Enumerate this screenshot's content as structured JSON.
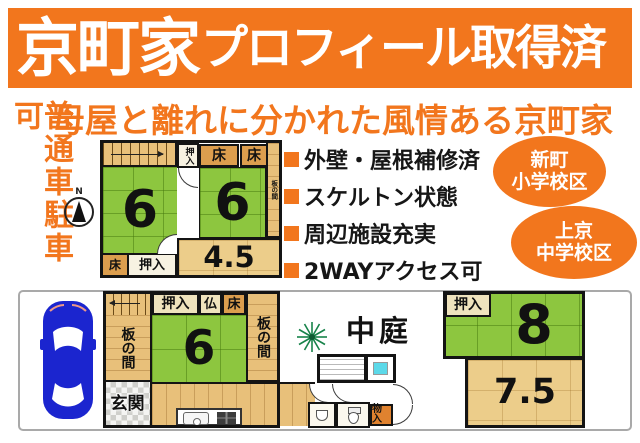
{
  "banner": {
    "title_emphasis": "京町家",
    "title_rest": "プロフィール取得済"
  },
  "subtitle": "母屋と離れに分かれた風情ある京町家",
  "parking_note": "普通車駐車可",
  "features": [
    "外壁・屋根補修済",
    "スケルトン状態",
    "周辺施設充実",
    "2WAYアクセス可"
  ],
  "badges": [
    {
      "line1": "新町",
      "line2": "小学校区"
    },
    {
      "line1": "上京",
      "line2": "中学校区"
    }
  ],
  "compass_label": "N",
  "floor2": {
    "closet_top": "押入",
    "toko_top_1": "床",
    "toko_top_2": "床",
    "itanoma_strip": "板の間",
    "room_left": "6",
    "room_right": "6",
    "room_small": "4.5",
    "toko_bottom": "床",
    "closet_bottom": "押入"
  },
  "floor1": {
    "closet": "押入",
    "butsudan": "仏",
    "toko": "床",
    "itanoma_left": "板の間",
    "itanoma_right": "板の間",
    "room_main": "6",
    "entrance": "玄関",
    "storage": "物入",
    "courtyard": "中庭"
  },
  "annex": {
    "closet": "押入",
    "room_upper": "8",
    "room_lower": "7.5"
  },
  "colors": {
    "accent_orange": "#f2761d",
    "tatami_green": "#8dc63f",
    "wood_tan": "#e8c07a",
    "toko_orange": "#dc9e4e",
    "room_tan": "#eccd8a",
    "bath_cyan": "#5cd9e9",
    "car_blue": "#1b25cf"
  }
}
